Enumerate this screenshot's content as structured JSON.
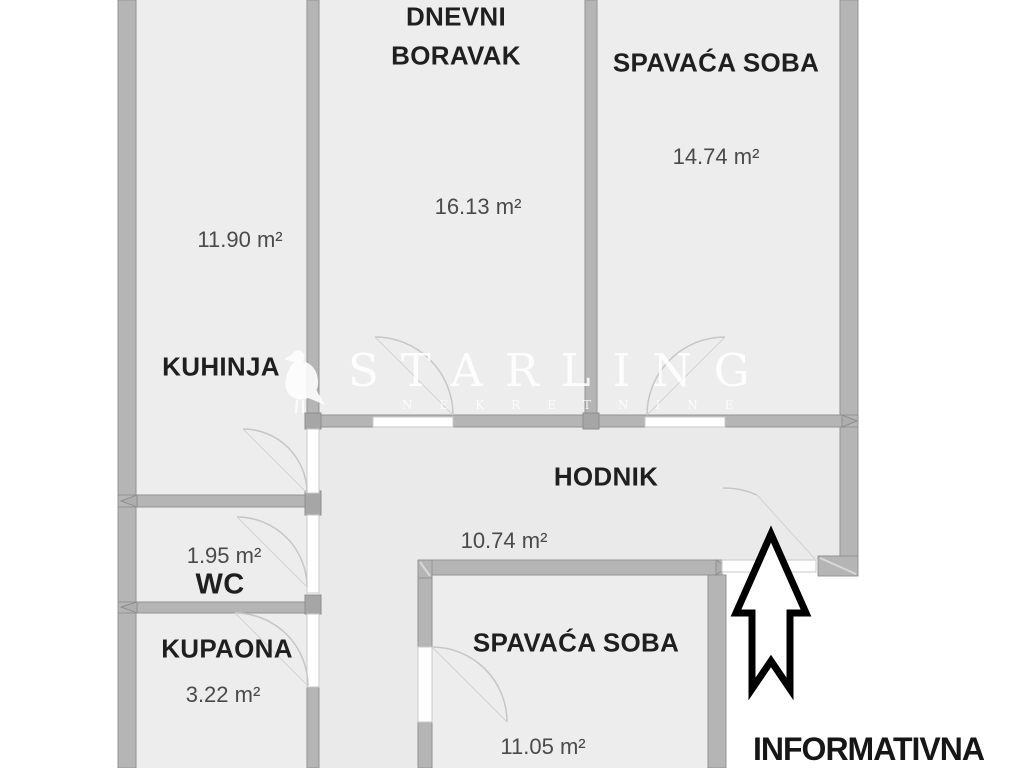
{
  "palette": {
    "background": "#ffffff",
    "floor": "#ededed",
    "hall_floor": "#eaeaea",
    "wall": "#b5b5b5",
    "wall_border": "#949494",
    "door_arc": "#c6c6c6",
    "room_name_color": "#1f1f1f",
    "area_color": "#4a4a4a",
    "arrow_color": "#000000",
    "watermark_color": "#ffffff"
  },
  "watermark": {
    "brand": "STARLING",
    "subtitle": "NEKRETNINE"
  },
  "note": {
    "text": "INFORMATIVNA"
  },
  "rooms": [
    {
      "id": "dnevni-boravak",
      "name_line1": "DNEVNI",
      "name_line2": "BORAVAK",
      "area": "16.13 m²"
    },
    {
      "id": "spavaca-soba-1",
      "name": "SPAVAĆA SOBA",
      "area": "14.74 m²"
    },
    {
      "id": "kuhinja",
      "name": "KUHINJA",
      "area": "11.90 m²"
    },
    {
      "id": "hodnik",
      "name": "HODNIK",
      "area": "10.74 m²"
    },
    {
      "id": "wc",
      "name": "WC",
      "area": "1.95 m²"
    },
    {
      "id": "kupaona",
      "name": "KUPAONA",
      "area": "3.22 m²"
    },
    {
      "id": "spavaca-soba-2",
      "name": "SPAVAĆA SOBA",
      "area": "11.05 m²"
    }
  ],
  "icons": {
    "bird": "starling-bird-watermark",
    "arrow": "entrance-up-arrow"
  }
}
